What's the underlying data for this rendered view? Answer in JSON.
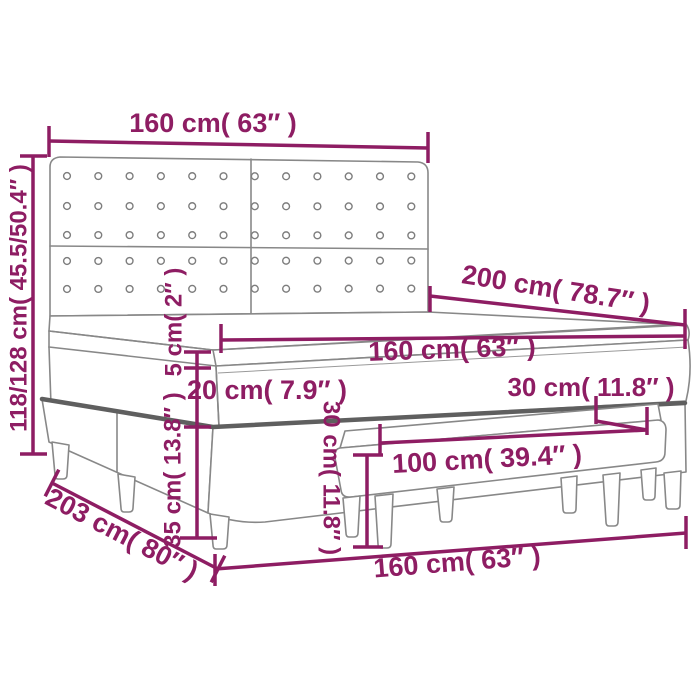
{
  "diagram": {
    "subject": "box-spring-bed-with-headboard-and-bench-dimension-drawing",
    "colors": {
      "dimension_annotation": "#8e1d63",
      "drawing_outline": "#888888",
      "drawing_outline_dark": "#5f5f5f",
      "background": "#ffffff"
    },
    "headboard": {
      "button_columns": 12,
      "button_rows": 5
    },
    "dims": {
      "headboard_width": {
        "label": "160 cm( 63″ )",
        "cm": "160",
        "inches": "63"
      },
      "headboard_height": {
        "label": "118/128 cm( 45.5/50.4″ )",
        "cm": "118/128",
        "inches": "45.5/50.4"
      },
      "bed_length": {
        "label": "200 cm( 78.7″ )",
        "cm": "200",
        "inches": "78.7"
      },
      "mattress_width": {
        "label": "160 cm( 63″ )",
        "cm": "160",
        "inches": "63"
      },
      "topper_thickness": {
        "label": "5 cm( 2″ )",
        "cm": "5",
        "inches": "2"
      },
      "mattress_thickness": {
        "label": "20 cm( 7.9″ )",
        "cm": "20",
        "inches": "7.9"
      },
      "box_height": {
        "label": "35 cm( 13.8″ )",
        "cm": "35",
        "inches": "13.8"
      },
      "base_length": {
        "label": "203 cm( 80″ )",
        "cm": "203",
        "inches": "80"
      },
      "bench_depth": {
        "label": "30 cm( 11.8″ )",
        "cm": "30",
        "inches": "11.8"
      },
      "bench_height": {
        "label": "30 cm( 11.8″ )",
        "cm": "30",
        "inches": "11.8"
      },
      "bench_width": {
        "label": "100 cm( 39.4″ )",
        "cm": "100",
        "inches": "39.4"
      },
      "base_width": {
        "label": "160 cm( 63″ )",
        "cm": "160",
        "inches": "63"
      }
    }
  }
}
